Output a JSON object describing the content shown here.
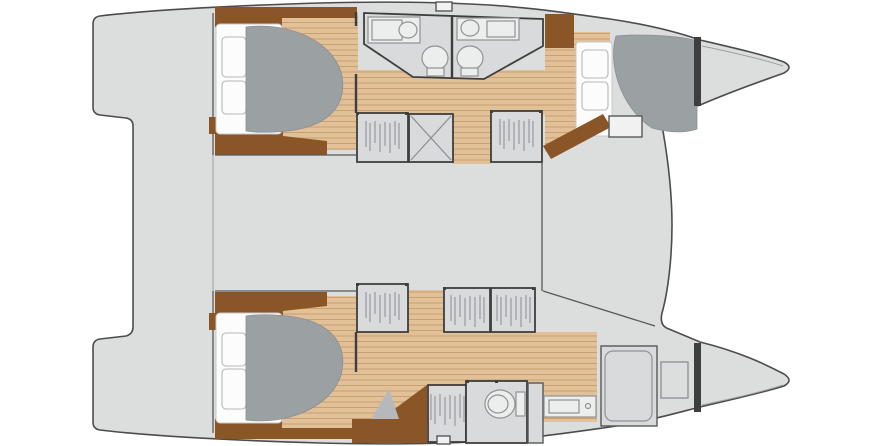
{
  "plan": {
    "kind": "catamaran-yacht-floor-plan",
    "orientation": "bow-right-stern-left",
    "deck_areas": [
      "aft-platform",
      "cockpit",
      "saloon-bridgedeck",
      "foredeck-lounge"
    ],
    "upper_hull": {
      "aft_cabin": [
        "double-berth",
        "two-pillows",
        "duvet",
        "side-cabinet",
        "inner-settee"
      ],
      "bathrooms": [
        "aft-head-with-vanity-and-toilet",
        "forward-head-with-vanity-and-toilet"
      ],
      "corridor": [
        "hanging-wardrobe",
        "companionway-steps",
        "hanging-wardrobe",
        "passage"
      ],
      "forward_cabin": [
        "double-berth",
        "two-pillows",
        "duvet",
        "step-locker"
      ],
      "bow": [
        "collision-bulkhead",
        "bow-compartment"
      ]
    },
    "lower_hull": {
      "aft_cabin": [
        "double-berth",
        "two-pillows",
        "duvet",
        "side-cabinet",
        "inner-settee"
      ],
      "corridor": [
        "hanging-wardrobe",
        "hanging-wardrobe",
        "hanging-wardrobe"
      ],
      "owner_suite": [
        "desk",
        "chair",
        "hanging-wardrobe",
        "toilet-room",
        "hanging-locker",
        "vanity-sink",
        "shower-room"
      ],
      "bow": [
        "storage-hatch",
        "collision-bulkhead",
        "bow-compartment"
      ]
    }
  },
  "palette": {
    "background": "#ffffff",
    "deck": "#dcdddd",
    "outline": "#4c4c4c",
    "wood": "#e2c098",
    "wood-line": "#c8a171",
    "dark-wood": "#8a5527",
    "duvet": "#9ba0a3",
    "sheet": "#fcfcfc",
    "room": "#d9dadb",
    "wall": "#3e3e3e",
    "fixture-line": "#8f9294",
    "hanger": "#9aa0a5",
    "chair": "#b5b9bd"
  }
}
